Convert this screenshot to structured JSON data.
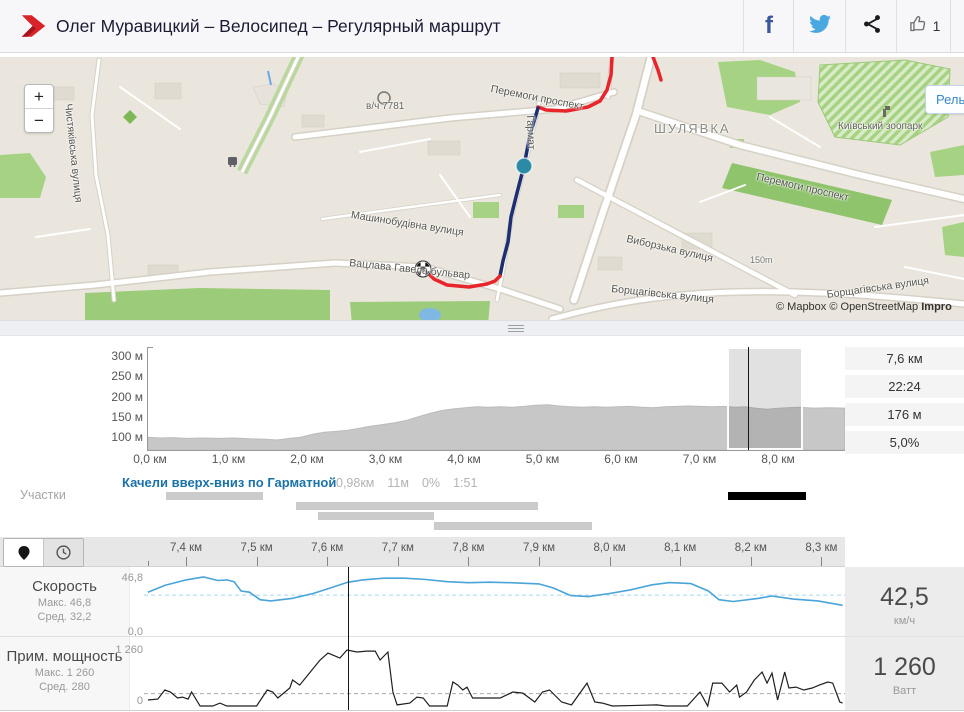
{
  "header": {
    "title": "Олег Муравицкий – Велосипед – Регулярный маршрут",
    "like_count": "1"
  },
  "map": {
    "zoom_in": "+",
    "zoom_out": "−",
    "terrain_button": "Рель",
    "attribution": "© Mapbox © OpenStreetMap ",
    "attribution_bold": "Impro",
    "labels": [
      "Перемоги проспект",
      "ШУЛЯВКА",
      "Київський зоопарк",
      "Перемоги проспект",
      "Чистяківська вулиця",
      "в/ч 7781",
      "Машинобудівна вулиця",
      "Вацлава Гавела бульвар",
      "Виборзька вулиця",
      "Борщагівська вулиця",
      "Борщагівська вулиця",
      "150m",
      "Гармат"
    ]
  },
  "elevation": {
    "y_ticks": [
      "300 м",
      "250 м",
      "200 м",
      "150 м",
      "100 м"
    ],
    "x_ticks": [
      "0,0 км",
      "1,0 км",
      "2,0 км",
      "3,0 км",
      "4,0 км",
      "5,0 км",
      "6,0 км",
      "7,0 км",
      "8,0 км"
    ],
    "stats": [
      "7,6 км",
      "22:24",
      "176 м",
      "5,0%"
    ]
  },
  "segment": {
    "section_label": "Участки",
    "title": "Качели вверх-вниз по Гарматной",
    "stats": [
      "0,98км",
      "11м",
      "0%",
      "1:51"
    ]
  },
  "bottom": {
    "ruler_ticks": [
      "7,4 км",
      "7,5 км",
      "7,6 км",
      "7,7 км",
      "7,8 км",
      "7,9 км",
      "8,0 км",
      "8,1 км",
      "8,2 км",
      "8,3 км"
    ],
    "speed": {
      "label": "Скорость",
      "max_label": "Макс. 46,8",
      "avg_label": "Сред. 32,2",
      "y_max": "46,8",
      "y_min": "0,0",
      "value": "42,5",
      "unit": "км/ч"
    },
    "power": {
      "label": "Прим. мощность",
      "max_label": "Макс. 1 260",
      "avg_label": "Сред. 280",
      "y_max": "1 260",
      "y_min": "0",
      "value": "1 260",
      "unit": "Ватт"
    }
  },
  "chart_data": [
    {
      "id": "elevation",
      "type": "area",
      "ylabel": "м",
      "xlabel": "км",
      "x_range": [
        0,
        8.9
      ],
      "y_range": [
        70,
        310
      ],
      "grid": false,
      "points": [
        [
          0,
          102
        ],
        [
          0.15,
          100
        ],
        [
          0.3,
          101
        ],
        [
          0.5,
          99
        ],
        [
          0.7,
          100
        ],
        [
          0.9,
          99
        ],
        [
          1.1,
          100
        ],
        [
          1.3,
          98
        ],
        [
          1.5,
          97
        ],
        [
          1.65,
          95
        ],
        [
          1.8,
          99
        ],
        [
          1.95,
          102
        ],
        [
          2.1,
          109
        ],
        [
          2.25,
          114
        ],
        [
          2.4,
          116
        ],
        [
          2.55,
          119
        ],
        [
          2.7,
          124
        ],
        [
          2.85,
          129
        ],
        [
          3,
          133
        ],
        [
          3.15,
          137
        ],
        [
          3.3,
          143
        ],
        [
          3.45,
          152
        ],
        [
          3.6,
          160
        ],
        [
          3.75,
          167
        ],
        [
          3.9,
          171
        ],
        [
          4.05,
          174
        ],
        [
          4.2,
          176
        ],
        [
          4.35,
          175
        ],
        [
          4.5,
          176
        ],
        [
          4.65,
          175
        ],
        [
          4.8,
          177
        ],
        [
          4.95,
          180
        ],
        [
          5.1,
          181
        ],
        [
          5.25,
          178
        ],
        [
          5.4,
          176
        ],
        [
          5.55,
          175
        ],
        [
          5.7,
          176
        ],
        [
          5.85,
          175
        ],
        [
          6,
          176
        ],
        [
          6.15,
          177
        ],
        [
          6.3,
          175
        ],
        [
          6.45,
          174
        ],
        [
          6.6,
          176
        ],
        [
          6.75,
          177
        ],
        [
          6.9,
          178
        ],
        [
          7.05,
          177
        ],
        [
          7.2,
          176
        ],
        [
          7.35,
          177
        ],
        [
          7.5,
          175
        ],
        [
          7.62,
          176
        ],
        [
          7.75,
          173
        ],
        [
          7.9,
          170
        ],
        [
          8,
          172
        ],
        [
          8.15,
          174
        ],
        [
          8.3,
          175
        ],
        [
          8.5,
          173
        ],
        [
          8.7,
          174
        ],
        [
          8.89,
          173
        ]
      ],
      "selection_km": [
        7.38,
        8.35
      ],
      "cursor_km": 7.63
    },
    {
      "id": "speed",
      "type": "line",
      "name": "Скорость",
      "unit": "км/ч",
      "max": 46.8,
      "avg": 32.2,
      "current": 42.5,
      "x_range": [
        7.35,
        8.33
      ],
      "y_range": [
        0,
        46.8
      ],
      "points": [
        [
          7.346,
          34.5
        ],
        [
          7.37,
          40
        ],
        [
          7.4,
          44.5
        ],
        [
          7.425,
          46.8
        ],
        [
          7.445,
          44
        ],
        [
          7.458,
          44.5
        ],
        [
          7.468,
          43
        ],
        [
          7.478,
          35.5
        ],
        [
          7.49,
          34.5
        ],
        [
          7.505,
          28.5
        ],
        [
          7.52,
          27.5
        ],
        [
          7.55,
          29.5
        ],
        [
          7.58,
          33.5
        ],
        [
          7.605,
          38
        ],
        [
          7.629,
          42.5
        ],
        [
          7.65,
          44.5
        ],
        [
          7.68,
          45.8
        ],
        [
          7.71,
          45.8
        ],
        [
          7.74,
          44.8
        ],
        [
          7.77,
          43
        ],
        [
          7.8,
          42.2
        ],
        [
          7.83,
          42.6
        ],
        [
          7.86,
          42.2
        ],
        [
          7.9,
          41.2
        ],
        [
          7.92,
          38
        ],
        [
          7.945,
          31.8
        ],
        [
          7.97,
          31
        ],
        [
          8,
          33.5
        ],
        [
          8.03,
          36.5
        ],
        [
          8.06,
          40.5
        ],
        [
          8.085,
          42.3
        ],
        [
          8.115,
          41.5
        ],
        [
          8.14,
          35.5
        ],
        [
          8.155,
          28.5
        ],
        [
          8.175,
          27
        ],
        [
          8.21,
          29.5
        ],
        [
          8.23,
          31.5
        ],
        [
          8.26,
          29
        ],
        [
          8.295,
          27.5
        ],
        [
          8.33,
          24
        ]
      ],
      "cursor_km": 7.63
    },
    {
      "id": "power",
      "type": "line",
      "name": "Прим. мощность",
      "unit": "Ватт",
      "max": 1260,
      "avg": 280,
      "current": 1260,
      "x_range": [
        7.35,
        8.33
      ],
      "y_range": [
        0,
        1260
      ],
      "points": [
        [
          7.346,
          135
        ],
        [
          7.36,
          155
        ],
        [
          7.37,
          360
        ],
        [
          7.378,
          315
        ],
        [
          7.388,
          180
        ],
        [
          7.395,
          200
        ],
        [
          7.403,
          155
        ],
        [
          7.408,
          315
        ],
        [
          7.42,
          0
        ],
        [
          7.438,
          0
        ],
        [
          7.448,
          65
        ],
        [
          7.458,
          0
        ],
        [
          7.5,
          0
        ],
        [
          7.515,
          360
        ],
        [
          7.523,
          315
        ],
        [
          7.53,
          180
        ],
        [
          7.547,
          405
        ],
        [
          7.551,
          585
        ],
        [
          7.561,
          470
        ],
        [
          7.576,
          765
        ],
        [
          7.59,
          1035
        ],
        [
          7.601,
          1190
        ],
        [
          7.608,
          1145
        ],
        [
          7.618,
          1080
        ],
        [
          7.628,
          1260
        ],
        [
          7.642,
          1215
        ],
        [
          7.656,
          1235
        ],
        [
          7.668,
          1235
        ],
        [
          7.675,
          1035
        ],
        [
          7.686,
          1215
        ],
        [
          7.693,
          315
        ],
        [
          7.699,
          25
        ],
        [
          7.717,
          65
        ],
        [
          7.727,
          200
        ],
        [
          7.736,
          180
        ],
        [
          7.745,
          0
        ],
        [
          7.77,
          0
        ],
        [
          7.778,
          540
        ],
        [
          7.785,
          470
        ],
        [
          7.792,
          360
        ],
        [
          7.798,
          425
        ],
        [
          7.806,
          180
        ],
        [
          7.845,
          180
        ],
        [
          7.863,
          315
        ],
        [
          7.877,
          290
        ],
        [
          7.894,
          90
        ],
        [
          7.905,
          315
        ],
        [
          7.915,
          360
        ],
        [
          7.932,
          90
        ],
        [
          7.946,
          25
        ],
        [
          7.968,
          515
        ],
        [
          7.979,
          90
        ],
        [
          7.99,
          65
        ],
        [
          8.004,
          0
        ],
        [
          8.067,
          25
        ],
        [
          8.08,
          0
        ],
        [
          8.11,
          0
        ],
        [
          8.128,
          315
        ],
        [
          8.139,
          0
        ],
        [
          8.146,
          515
        ],
        [
          8.159,
          515
        ],
        [
          8.17,
          315
        ],
        [
          8.18,
          470
        ],
        [
          8.184,
          200
        ],
        [
          8.194,
          315
        ],
        [
          8.205,
          585
        ],
        [
          8.216,
          765
        ],
        [
          8.223,
          515
        ],
        [
          8.23,
          740
        ],
        [
          8.238,
          135
        ],
        [
          8.248,
          765
        ],
        [
          8.254,
          405
        ],
        [
          8.264,
          425
        ],
        [
          8.275,
          360
        ],
        [
          8.287,
          405
        ],
        [
          8.297,
          470
        ],
        [
          8.309,
          540
        ],
        [
          8.316,
          515
        ],
        [
          8.326,
          90
        ],
        [
          8.33,
          65
        ]
      ],
      "cursor_km": 7.63
    }
  ]
}
